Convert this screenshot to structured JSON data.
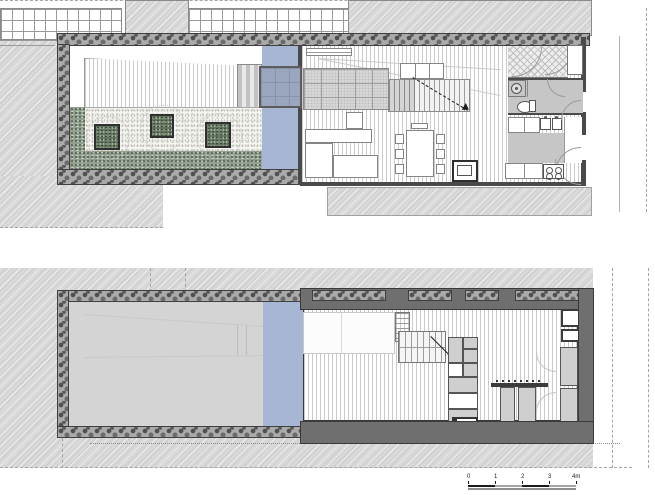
{
  "scale_bar": {
    "labels": [
      "0",
      "1",
      "2",
      "3",
      "4m"
    ],
    "bar_dark_color": "#1c1c1c",
    "bar_light_color": "#a5a5a5"
  },
  "colors": {
    "water_feature": "#a8b6d5",
    "glass_bridge": "#9aa6bd",
    "dark_wall": "#6f6f6f",
    "stone_wall": "#aaaaaa",
    "surrounding_hatch": "#d9d9d9",
    "wet_room_floor": "#c6c6c6",
    "planting_bed": "#93a090",
    "planter_box": "#66765f"
  }
}
